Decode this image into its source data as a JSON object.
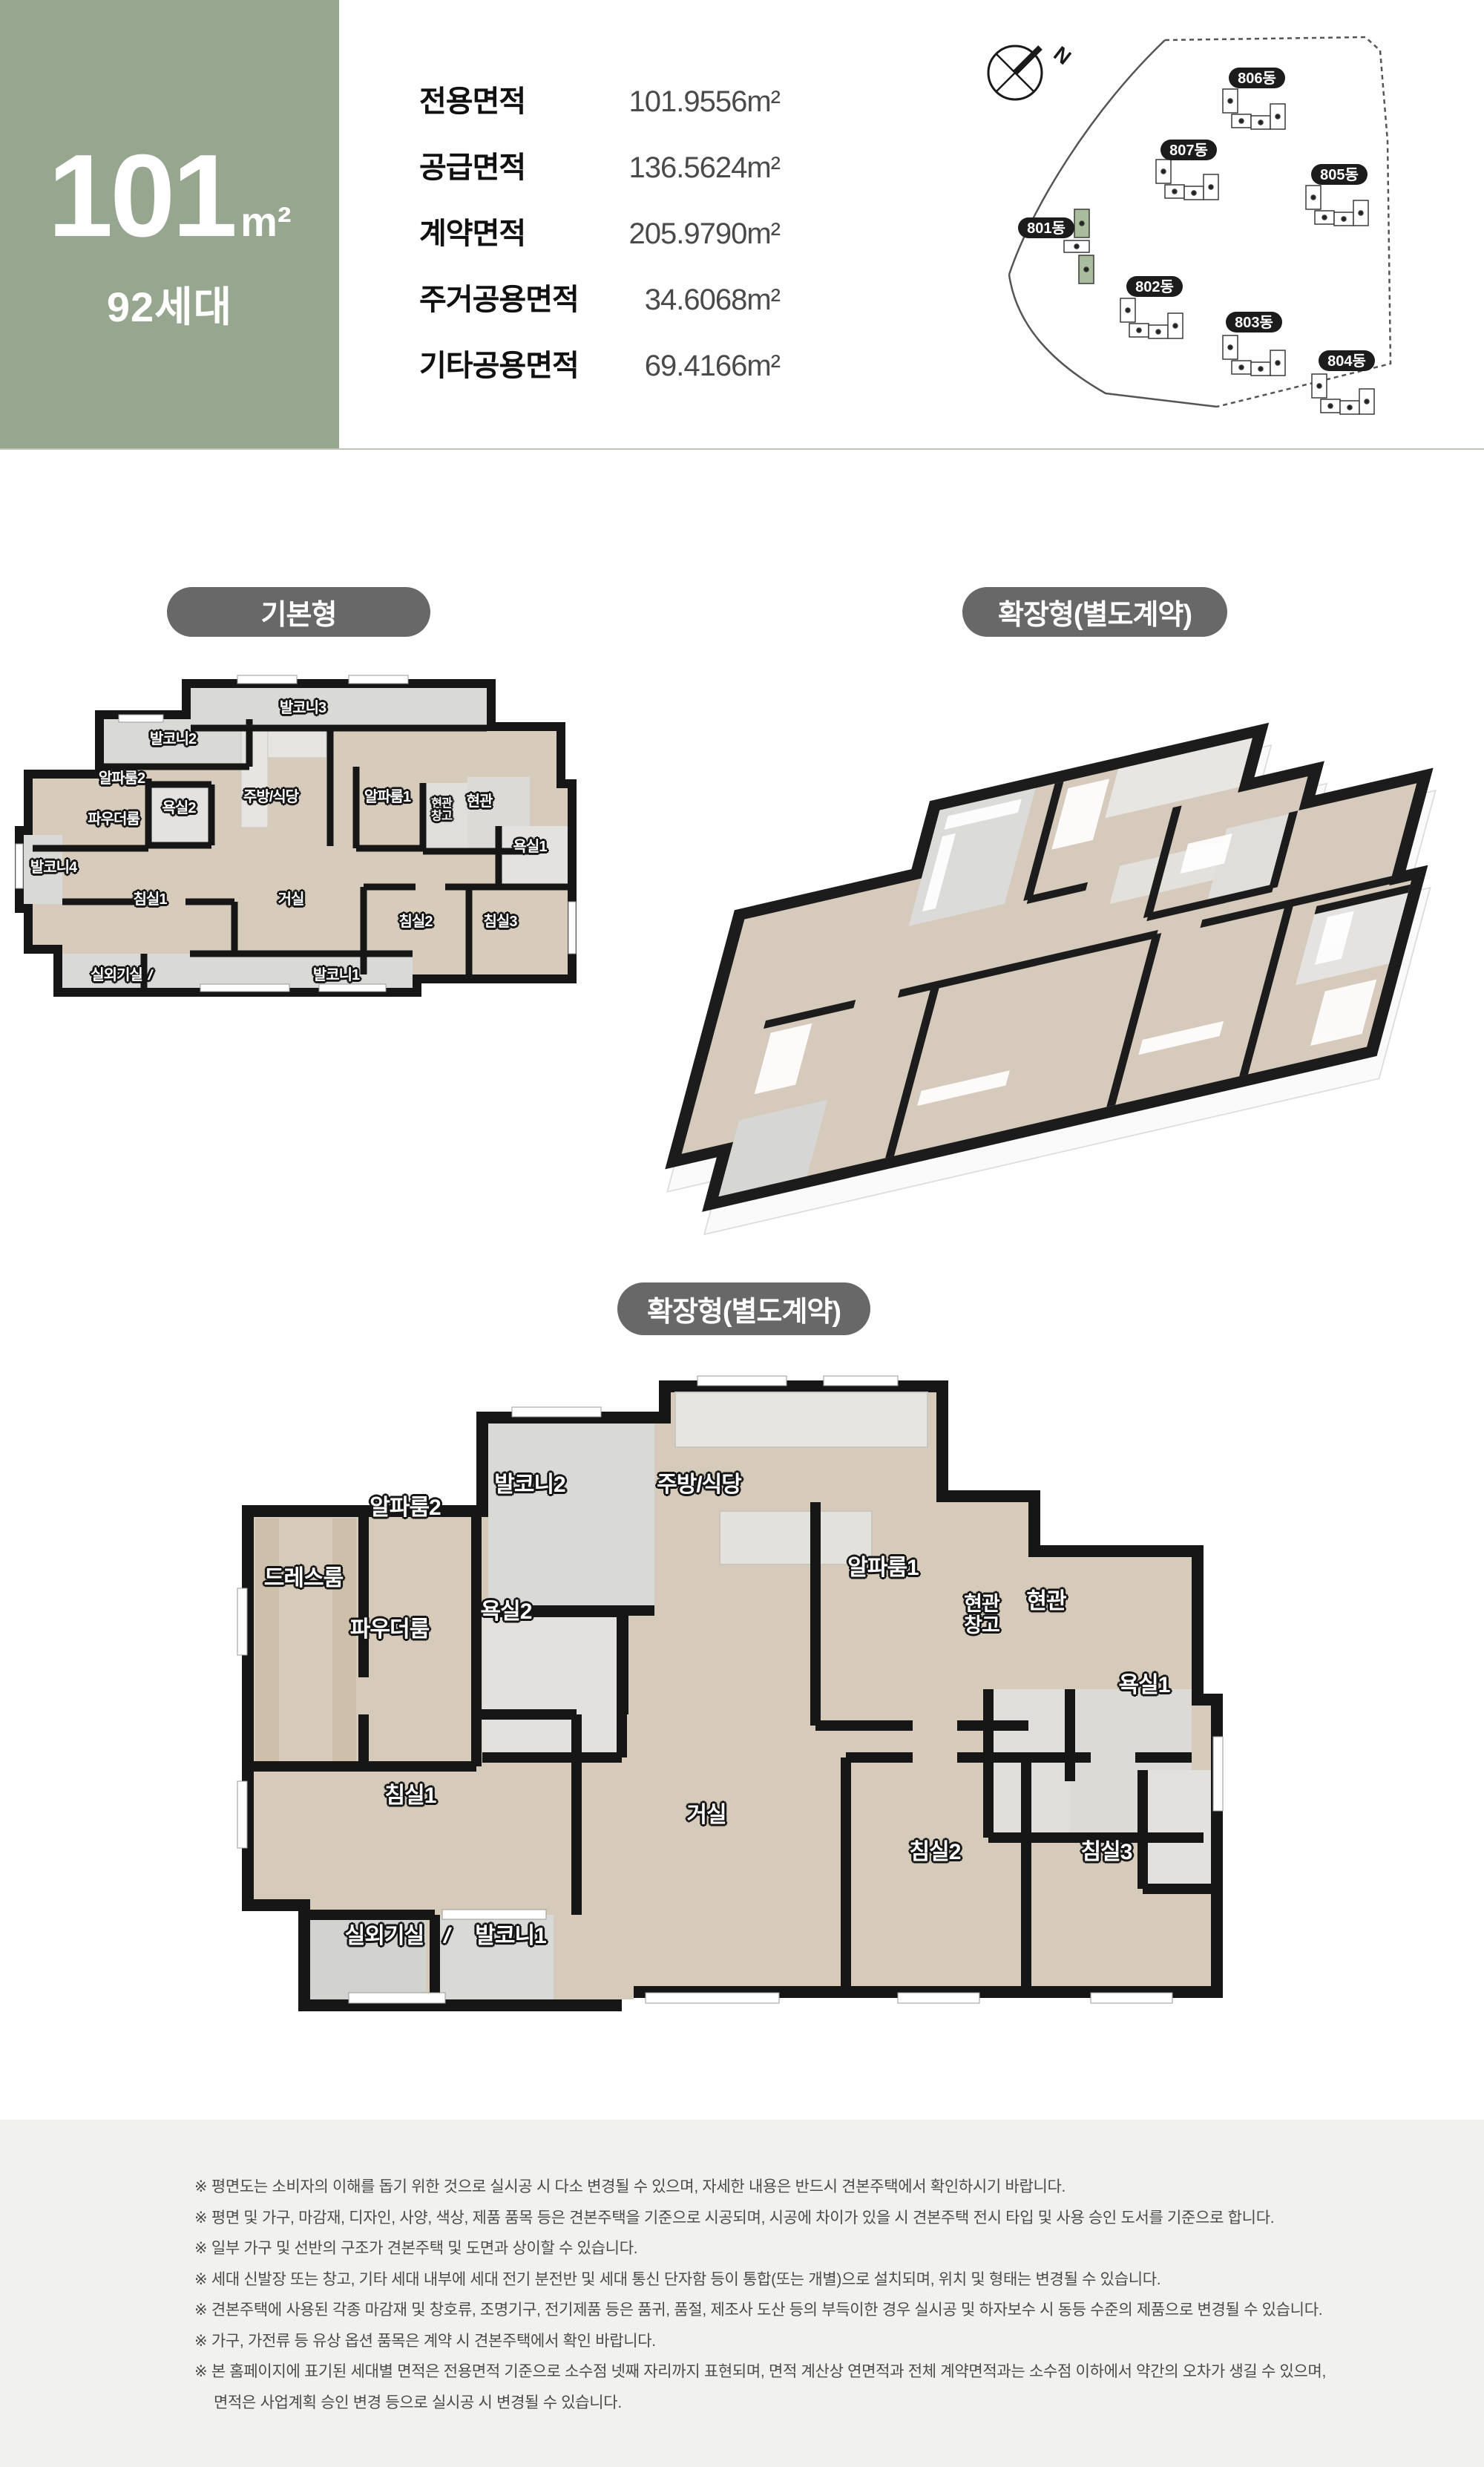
{
  "header": {
    "area_number": "101",
    "area_unit": "m²",
    "unit_count": "92세대",
    "area_table": [
      {
        "label": "전용면적",
        "value": "101.9556m²"
      },
      {
        "label": "공급면적",
        "value": "136.5624m²"
      },
      {
        "label": "계약면적",
        "value": "205.9790m²"
      },
      {
        "label": "주거공용면적",
        "value": "34.6068m²"
      },
      {
        "label": "기타공용면적",
        "value": "69.4166m²"
      }
    ],
    "site_map": {
      "north_label": "N",
      "buildings": [
        "806동",
        "807동",
        "805동",
        "801동",
        "802동",
        "803동",
        "804동"
      ]
    }
  },
  "sections": {
    "basic_pill": "기본형",
    "extended_pill_right": "확장형(별도계약)",
    "extended_pill_center": "확장형(별도계약)"
  },
  "plans": {
    "divider": "/",
    "basic": {
      "rooms": [
        "발코니3",
        "발코니2",
        "알파룸2",
        "주방/식당",
        "알파룸1",
        "현관\n창고",
        "현관",
        "욕실2",
        "파우더룸",
        "발코니4",
        "욕실1",
        "침실1",
        "거실",
        "침실2",
        "침실3",
        "실외기실",
        "발코니1"
      ]
    },
    "extended": {
      "rooms": [
        "발코니2",
        "주방/식당",
        "알파룸2",
        "드레스룸",
        "파우더룸",
        "욕실2",
        "알파룸1",
        "현관\n창고",
        "현관",
        "욕실1",
        "침실1",
        "거실",
        "침실2",
        "침실3",
        "실외기실",
        "발코니1"
      ]
    }
  },
  "disclaimers": [
    "※ 평면도는 소비자의 이해를 돕기 위한 것으로 실시공 시 다소 변경될 수 있으며, 자세한 내용은 반드시 견본주택에서 확인하시기 바랍니다.",
    "※ 평면 및 가구, 마감재, 디자인, 사양, 색상, 제품 품목 등은 견본주택을 기준으로 시공되며, 시공에 차이가 있을 시 견본주택 전시 타입 및 사용 승인 도서를 기준으로 합니다.",
    "※ 일부 가구 및 선반의 구조가 견본주택 및 도면과 상이할 수 있습니다.",
    "※ 세대 신발장 또는 창고, 기타 세대 내부에 세대 전기 분전반 및 세대 통신 단자함 등이 통합(또는 개별)으로 설치되며, 위치 및 형태는 변경될 수 있습니다.",
    "※ 견본주택에 사용된 각종 마감재 및 창호류, 조명기구, 전기제품 등은 품귀, 품절, 제조사 도산 등의 부득이한 경우 실시공 및 하자보수 시 동등 수준의 제품으로 변경될 수 있습니다.",
    "※ 가구, 가전류 등 유상 옵션 품목은 계약 시 견본주택에서 확인 바랍니다.",
    "※ 본 홈페이지에 표기된 세대별 면적은 전용면적 기준으로 소수점 넷째 자리까지 표현되며, 면적 계산상 연면적과 전체 계약면적과는 소수점 이하에서 약간의 오차가 생길 수 있으며,",
    "면적은 사업계획 승인 변경 등으로 실시공 시 변경될 수 있습니다."
  ]
}
